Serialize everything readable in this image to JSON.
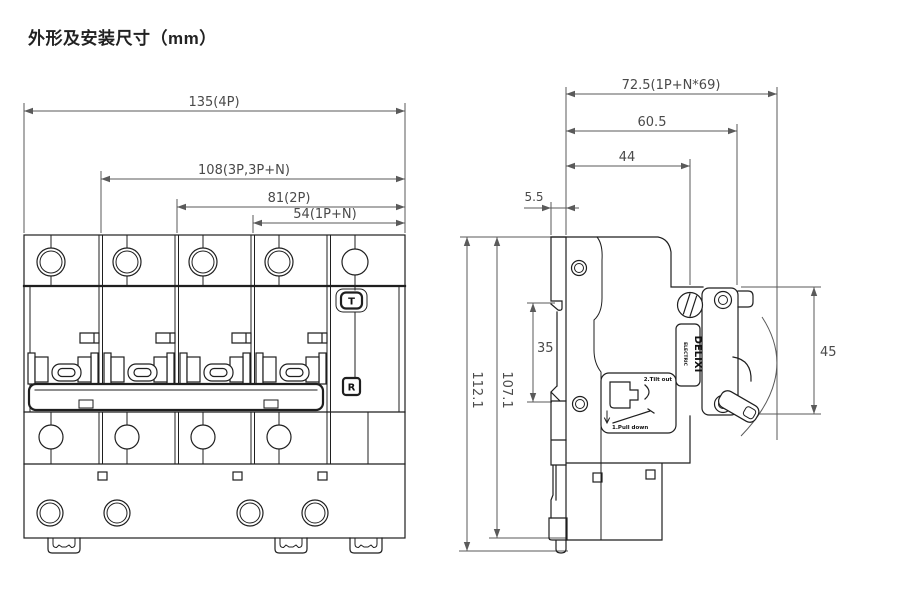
{
  "title": "外形及安装尺寸（mm）",
  "front": {
    "dims": {
      "w4p": "135(4P)",
      "w3p": "108(3P,3P+N)",
      "w2p": "81(2P)",
      "w1pn": "54(1P+N)"
    },
    "test_button": "T",
    "reset_button": "R"
  },
  "side": {
    "dims": {
      "total_width": "72.5(1P+N*69)",
      "front_width": "60.5",
      "body_width": "44",
      "rail_offset": "5.5",
      "front_face_height": "45",
      "din_slot": "35",
      "total_height": "112.1",
      "body_height": "107.1"
    },
    "brand": "DELIXI",
    "brand_sub": "ELECTRIC",
    "label": {
      "step2": "2.Tilt out",
      "step1": "1.Pull down"
    }
  },
  "colors": {
    "outline": "#1f1f1f",
    "dimension": "#5a5a5a"
  }
}
